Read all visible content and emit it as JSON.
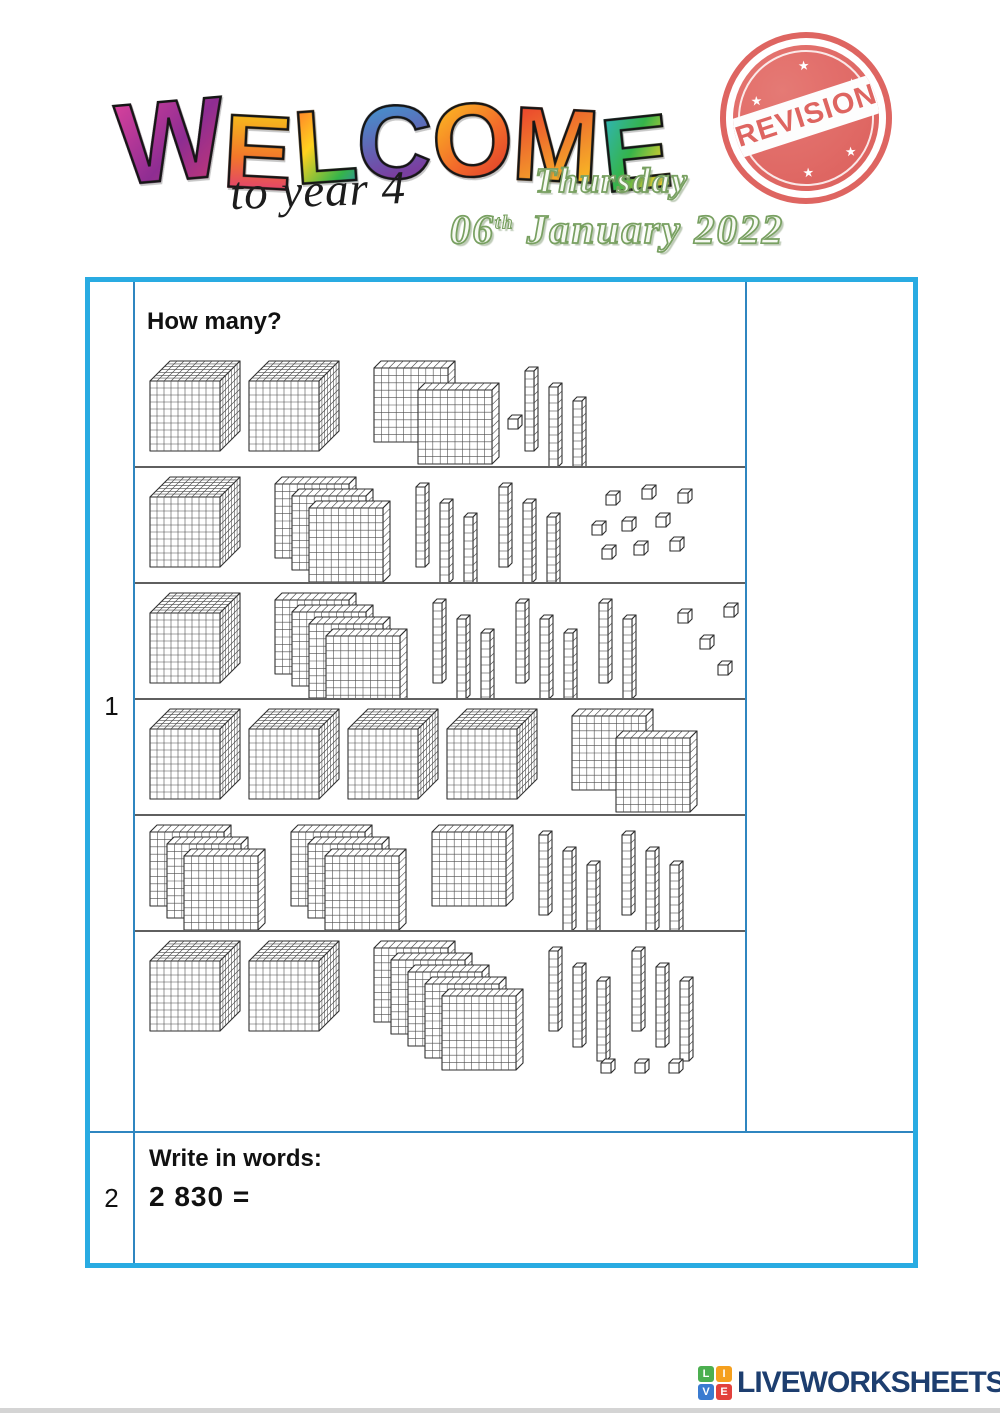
{
  "header": {
    "welcome_word": "WELCOME",
    "welcome_sub": "to year 4",
    "weekday": "Thursday",
    "date_day": "06",
    "date_ordinal": "th",
    "date_rest": " January 2022",
    "stamp_text": "REVISION"
  },
  "questions": {
    "q1": {
      "number": "1",
      "prompt": "How many?",
      "block_rows": [
        {
          "thousands": 2,
          "hundreds": 2,
          "tens": 3,
          "ones": 1,
          "represents": 2231
        },
        {
          "thousands": 1,
          "hundreds": 3,
          "tens": 6,
          "ones": 9,
          "represents": 1369
        },
        {
          "thousands": 1,
          "hundreds": 4,
          "tens": 8,
          "ones": 5,
          "represents": 1485
        },
        {
          "thousands": 4,
          "hundreds": 2,
          "tens": 0,
          "ones": 0,
          "represents": 4200
        },
        {
          "thousands": 0,
          "hundreds": 7,
          "tens": 6,
          "ones": 0,
          "represents": 760
        },
        {
          "thousands": 2,
          "hundreds": 5,
          "tens": 6,
          "ones": 3,
          "represents": 2563
        }
      ]
    },
    "q2": {
      "number": "2",
      "prompt": "Write in words:",
      "expression": "2 830 ="
    }
  },
  "footer": {
    "logo_letters": [
      "L",
      "I",
      "V",
      "E"
    ],
    "logo_text": "LIVEWORKSHEETS"
  },
  "colors": {
    "table_border": "#29abe2",
    "inner_line": "#2f86c0",
    "row_divider": "#5f5f5f",
    "stamp_red": "#dc5a56",
    "date_green": "#78a061",
    "logo_navy": "#1d3e6f",
    "logo_green": "#4caf50",
    "logo_orange": "#f5a01e",
    "logo_blue": "#3a7bd0",
    "logo_red": "#e2413c"
  }
}
